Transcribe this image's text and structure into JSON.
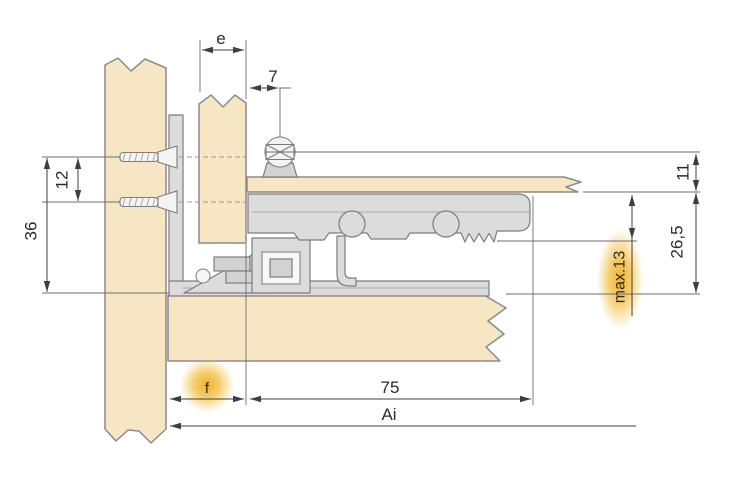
{
  "drawing": {
    "type": "technical-cross-section",
    "description": "Installation cross-section of a pull-out runner / mounting profile between wooden cabinet panels with dimension annotations",
    "background": "#ffffff"
  },
  "labels": {
    "e": "e",
    "seven": "7",
    "eleven": "11",
    "twelve": "12",
    "thirty_six": "36",
    "twenty_six_comma_five": "26,5",
    "max_thirteen": "max.13",
    "seventy_five": "75",
    "f": "f",
    "ai": "Ai"
  },
  "highlighted_labels": [
    "max.13",
    "f"
  ],
  "colors": {
    "wood": "#f7e6c3",
    "wood_outline": "#8b8b8b",
    "metal": "#dcdcdc",
    "metal_outline": "#7d7d7d",
    "dimension_line": "#3f3f3f",
    "text": "#2b2b2b",
    "highlight_glow": "#f2b52e",
    "background": "#ffffff"
  }
}
